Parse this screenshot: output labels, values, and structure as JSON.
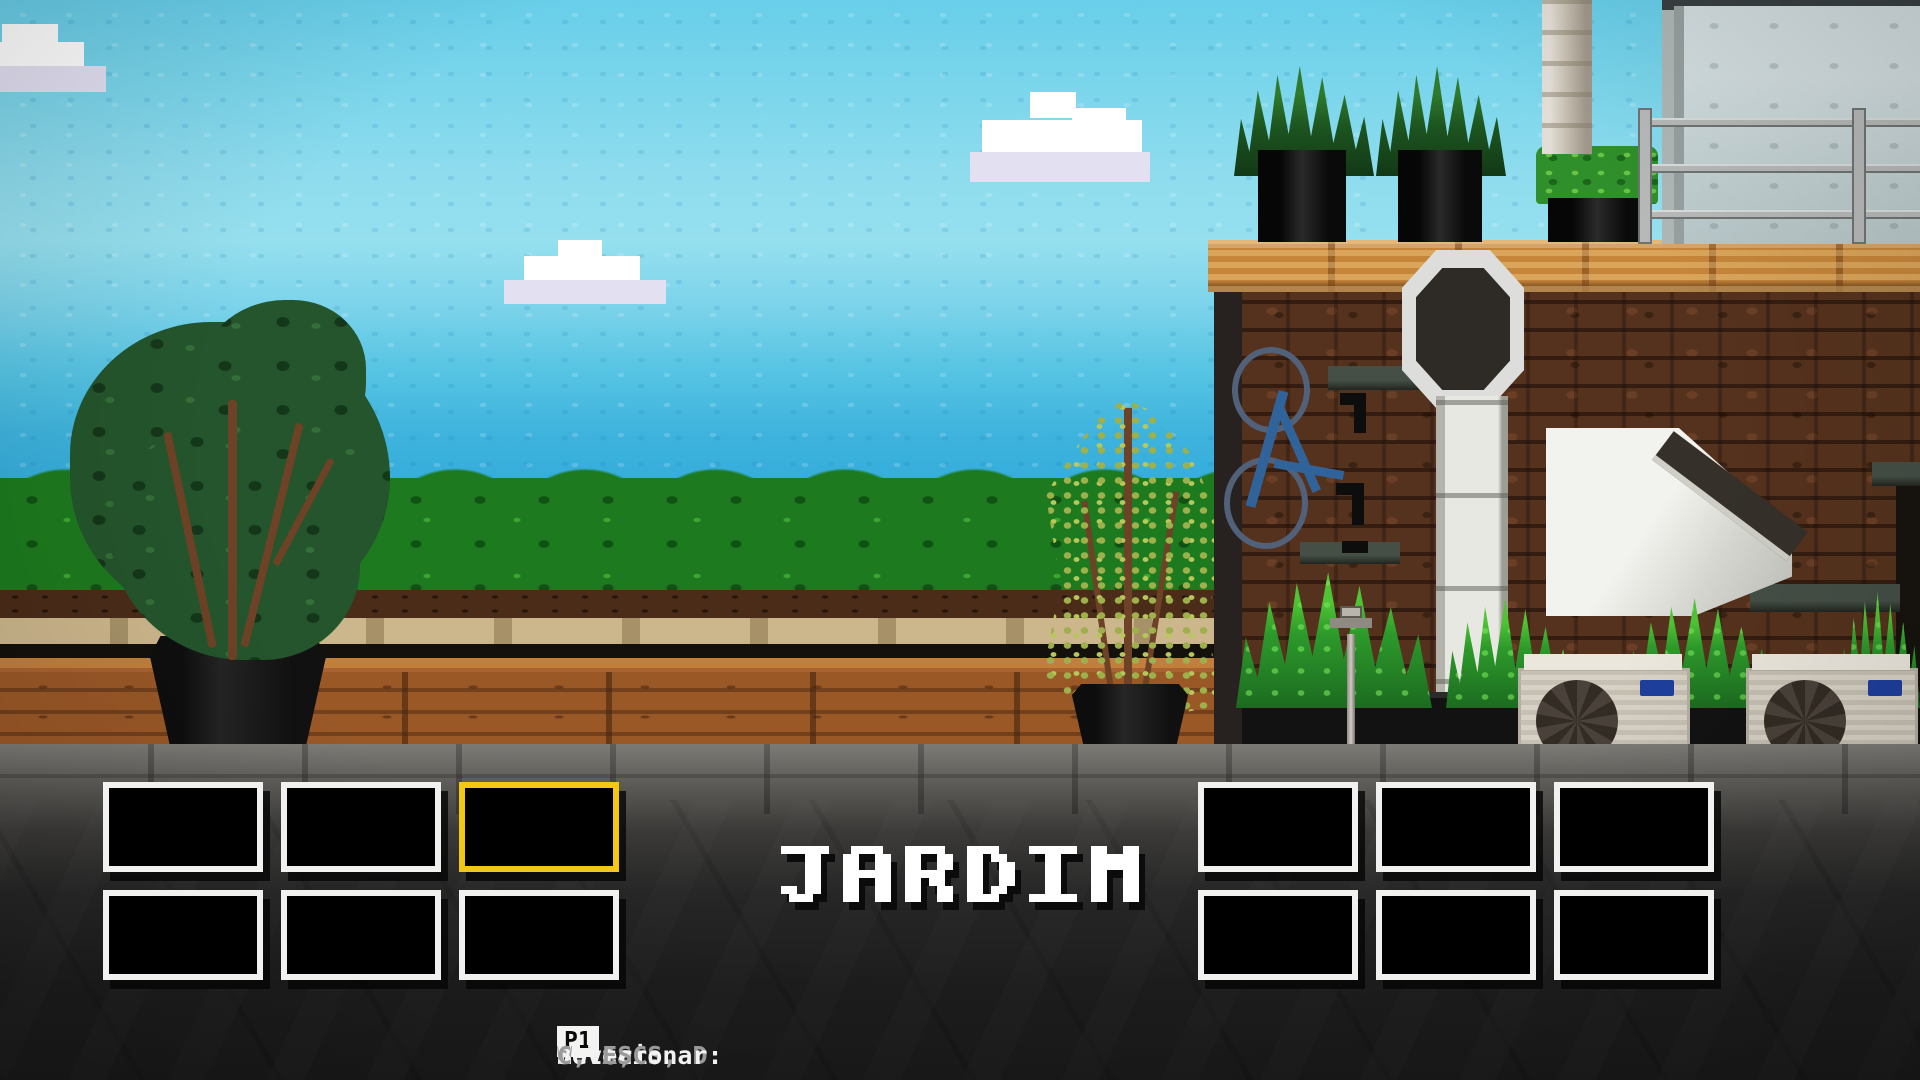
{
  "title": {
    "text": "JARDIM"
  },
  "hud": {
    "player_badge": "P1",
    "controls": [
      {
        "label": "Mover:",
        "keys": "W, A, S, D"
      },
      {
        "label": "Selecionar:",
        "keys": "V"
      },
      {
        "label": "Voltar:",
        "keys": "C, ESC"
      }
    ]
  },
  "colors": {
    "accent_selected": "#f4c712",
    "sky_top": "#68cee9",
    "sky_horizon": "#2aa3d8",
    "hedge_green": "#1d7a1e",
    "wood_planter": "#9a5827",
    "brick_wall": "#55321d",
    "wood_cap": "#c6863a",
    "panel_dark": "#1d1d1d",
    "thumb_frame": "#f1f1ef",
    "mystery_blue": "#4a8ad8"
  },
  "thumbnails": {
    "left": [
      {
        "id": "casa-exterior",
        "selected": false,
        "palette": {
          "w": "#e7eaea",
          "W": "#f3f5f5",
          "c": "#bfe7f3",
          "d": "#2d3031",
          "g": "#3f8a33",
          "G": "#2b6326",
          "b": "#7b5233",
          "p": "#989b99",
          "P": "#b6b9b7",
          "m": "#6f7270"
        },
        "rows": [
          "wwwcwwwwddww",
          "wWbcwWwdddgw",
          "gbgGbwwdddgw",
          "GgmpbPpmpgpp",
          "pmpPpmpPgppm",
          "PpPpPpPpPpPp",
          "pPmPpPpPpPmP"
        ]
      },
      {
        "id": "cozinha",
        "selected": false,
        "palette": {
          "t": "#b3a78f",
          "T": "#c6bba3",
          "d": "#24221f",
          "w": "#eeeeec",
          "o": "#e2a23c",
          "f": "#8a7f6b",
          "b": "#6d4b2e",
          "B": "#8c5c33"
        },
        "rows": [
          "tTttttttwwtT",
          "twwddddwwtwt",
          "twoddddwtTdt",
          "twwwwwwwtddt",
          "tTttttttbBtt",
          "tffbBbffftff",
          "ffffffffffff"
        ]
      },
      {
        "id": "jardim",
        "selected": true,
        "palette": {
          "s": "#63c3e4",
          "S": "#9fdcf0",
          "w": "#ffffff",
          "t": "#7fa944",
          "g": "#2f8c2a",
          "G": "#1e671f",
          "b": "#593921",
          "n": "#ccb68c",
          "o": "#a65d29",
          "O": "#bb6c31",
          "p": "#8d8d8b",
          "P": "#a4a4a2",
          "d": "#39332b"
        },
        "rows": [
          "tsssssSwssdd",
          "tgsssssssbdb",
          "ggggggggbbwb",
          "GgGgGgGgbwwb",
          "nnnnnnnnpbpp",
          "oOoOoOppPpPp",
          "pPpPpPpPpPpP"
        ]
      },
      {
        "id": "jardim-noite",
        "selected": false,
        "palette": {
          "u": "#2a4fd0",
          "U": "#3a66e8",
          "d": "#0e180f",
          "g": "#1d4721",
          "G": "#2a682c",
          "r": "#a03020",
          "p": "#66696b",
          "P": "#7b8083",
          "w": "#e6e6e6"
        },
        "rows": [
          "dudUgdduUddu",
          "gdUggGdguGdg",
          "dGgwwdGgdggd",
          "gdgGdgrdGgdg",
          "pdppGpppppgp",
          "pPpdpPpGpPpp",
          "PpPpPpPpPpPp"
        ]
      },
      {
        "id": "escritorio",
        "selected": false,
        "palette": {
          "a": "#9aa0a2",
          "A": "#b4babc",
          "y": "#e9e5c9",
          "c": "#d9ceb5",
          "C": "#eae2ce",
          "d": "#2a2a2a",
          "o": "#c8803a",
          "l": "#9ac83a",
          "r": "#a82a2a",
          "f": "#8b8377",
          "b": "#8a5a2e"
        },
        "rows": [
          "aycCcyaAyaya",
          "aAacCaaAaAaa",
          "adacCadadAoa",
          "obacCobdbdra",
          "ablcCablblra",
          "ffffCfffffff",
          "ffffffffffff"
        ]
      },
      {
        "id": "interior-claro",
        "selected": false,
        "palette": {
          "w": "#f1f3f3",
          "i": "#cfe6f2",
          "I": "#b6d7e9",
          "d": "#1d1d1d",
          "g": "#c3c7c7"
        },
        "rows": [
          "wwwwwwwwwwww",
          "wwwwwwwwwwww",
          "wiIwiIwiIwiw",
          "wdddwdddwddw",
          "dddddddddddd",
          "wdgwddwgdwdd",
          "wwwwwwwwwwww"
        ]
      }
    ],
    "right": [
      {
        "id": "bar-noite",
        "selected": false,
        "palette": {
          "k": "#1b1b1b",
          "K": "#2a2a28",
          "w": "#d6d6d4",
          "u": "#3a6ad8",
          "y": "#e8c83a",
          "d": "#3a3026",
          "g": "#55534e",
          "r": "#8a2020"
        },
        "rows": [
          "gwKwKwKwKwgK",
          "kKkKkKkKyKkk",
          "KkKkKkKKkKkK",
          "kukukKdkdkyk",
          "rdkdkdkdkdkd",
          "kKkgKkKkkkKk",
          "KkKkKkKkKkKk"
        ]
      },
      {
        "id": "fachada-branca",
        "selected": false,
        "palette": {
          "w": "#eceeec",
          "W": "#f6f8f6",
          "g": "#c8ccca",
          "d": "#3a3e3c",
          "t": "#2a5e2c",
          "b": "#5a3420",
          "B": "#6b4226",
          "l": "#3a8a3a"
        },
        "rows": [
          "wgdgwwwwwdtw",
          "wWwwwwwwwwtw",
          "gwwwwwwgdwgw",
          "wwwwgwwwdwww",
          "bBbBbBlbBwbB",
          "BblbBbBbBbBb",
          "bBbBlbBbBblb"
        ]
      },
      {
        "id": "garagem",
        "selected": false,
        "palette": {
          "k": "#33302c",
          "K": "#403c38",
          "u": "#3a4ad8",
          "U": "#2a3ab0",
          "y": "#e8c020",
          "g": "#2a7a2a",
          "w": "#e8e8e8",
          "r": "#c03030",
          "b": "#7a4a26",
          "p": "#8a8682"
        },
        "rows": [
          "kKkKkKkKkgKk",
          "KpKkKpkuKgwr",
          "kpkKkKkwkKkk",
          "kpKkKuUkbKpk",
          "kykKkUUkbkpk",
          "KkKkKkKkKkKk",
          "kKkKkKkKkKkK"
        ]
      },
      {
        "id": "loja",
        "selected": false,
        "palette": {
          "t": "#8a7f6e",
          "T": "#9a9080",
          "y": "#e8c020",
          "k": "#191919",
          "w": "#c8c4bc",
          "g": "#4a7a3a",
          "c": "#3a7a6a",
          "o": "#c8913a",
          "u": "#2a4a8a",
          "f": "#55504a"
        },
        "rows": [
          "ttkykykykttt",
          "twtyyyyywtwt",
          "twgtgtwtgtwt",
          "tcccccccccct",
          "fkofkkfkkukf",
          "fkkfkkfkkkkf",
          "ffffffffffff"
        ]
      },
      {
        "id": "cidade-por-do-sol",
        "selected": false,
        "palette": {
          "o": "#e07020",
          "O": "#ea8c30",
          "y": "#f0b020",
          "Y": "#f9c930",
          "d": "#5a5a56",
          "D": "#6b6b67",
          "g": "#1e4a26",
          "G": "#2a5e2e",
          "p": "#a8a49c",
          "P": "#b8b4ac",
          "k": "#3a3a36"
        },
        "rows": [
          "oOoOoOoOoOoO",
          "OoOoOoyYoOoO",
          "oOodOoYYOoOo",
          "oDdOdDyYdOoD",
          "GgGgDdGgGgGg",
          "pPkpPpkPpPkp",
          "PpPpPpPpPpPp"
        ]
      },
      {
        "id": "misterio",
        "selected": false,
        "palette": {
          "u": "#4a8ad8",
          "U": "#3b76c3",
          "w": "#f2f2f2",
          "k": "#111111"
        },
        "rows": [
          "uUuUuUuUuUuU",
          "uUuwwwwUuUuU",
          "UuUukUwwUuUu",
          "uUuUuwwkUuUu",
          "UuUuUwkUuUuU",
          "uUuUuUuUuUuU",
          "UuUuUwwUuUuU"
        ]
      }
    ]
  }
}
